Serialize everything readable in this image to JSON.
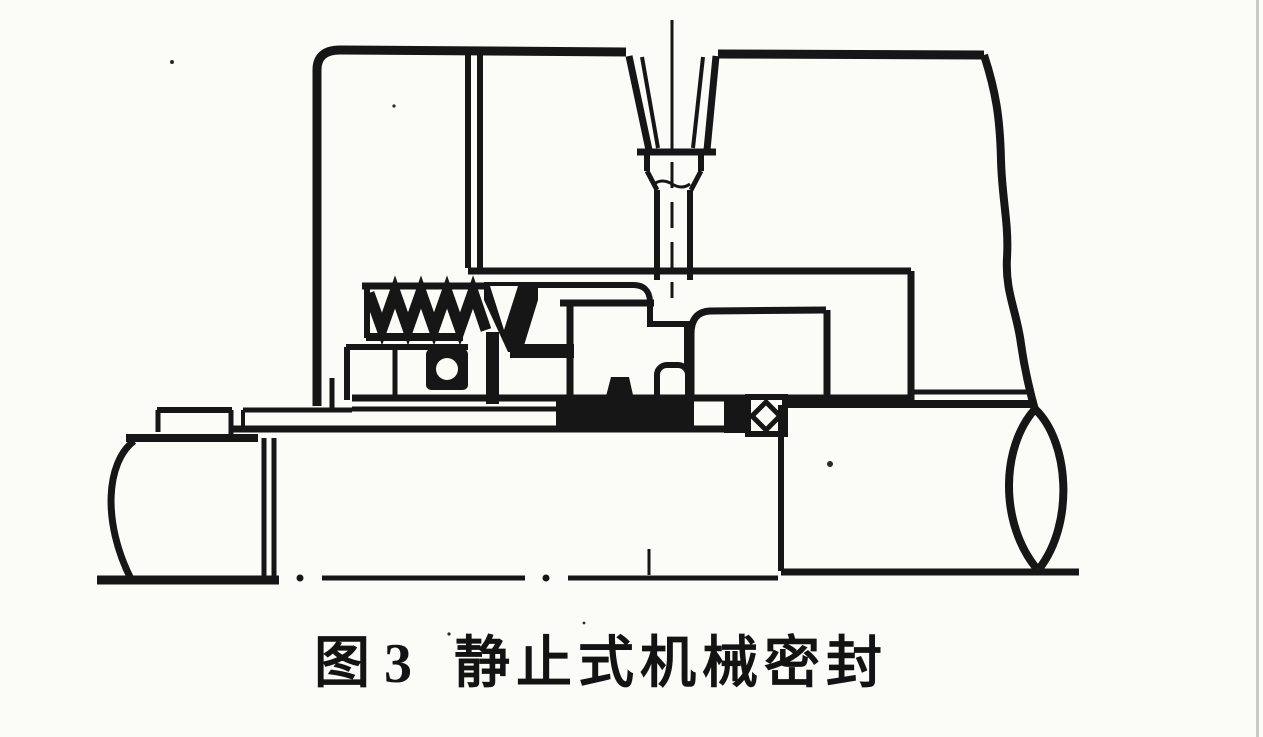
{
  "page": {
    "background_color": "#fbfbf7",
    "ink_color": "#161616",
    "scan_edge_color": "#b3b3af"
  },
  "figure": {
    "caption_prefix": "图 3",
    "caption_title": "静止式机械密封"
  }
}
